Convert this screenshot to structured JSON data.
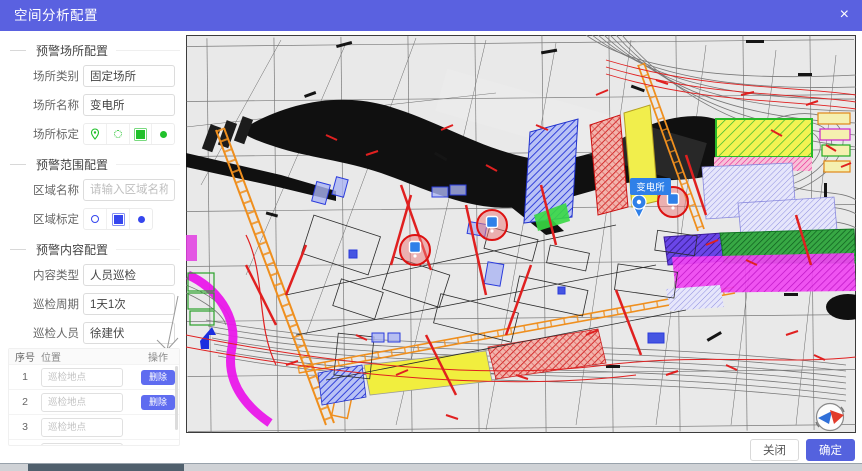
{
  "dialog": {
    "title": "空间分析配置",
    "close_glyph": "×"
  },
  "colors": {
    "titlebar": "#5a61e0",
    "primary_button": "#5462de",
    "delete_button": "#5f6cf0",
    "place_tools_green": "#21c12b",
    "range_tools_blue": "#3546ee",
    "inspect_tools_red": "#ee2f2f",
    "map_marker_blue": "#2f80e8",
    "inspection_circle_red": "#dd1111"
  },
  "sections": {
    "place": {
      "title": "预警场所配置",
      "category_label": "场所类别",
      "category_value": "固定场所",
      "name_label": "场所名称",
      "name_value": "变电所",
      "calibrate_label": "场所标定",
      "tool_icons": [
        "map-pin",
        "circle",
        "square",
        "dot"
      ]
    },
    "range": {
      "title": "预警范围配置",
      "area_label": "区域名称",
      "area_placeholder": "请输入区域名称",
      "calibrate_label": "区域标定",
      "tool_icons": [
        "circle",
        "square",
        "dot"
      ]
    },
    "content": {
      "title": "预警内容配置",
      "type_label": "内容类型",
      "type_value": "人员巡检",
      "cycle_label": "巡检周期",
      "cycle_value": "1天1次",
      "person_label": "巡检人员",
      "person_value": "徐建伏",
      "location_label": "巡检地点",
      "tool_icons": [
        "circle",
        "square",
        "dot"
      ]
    }
  },
  "table": {
    "headers": {
      "index": "序号",
      "location": "位置",
      "action": "操作"
    },
    "location_placeholder": "巡检地点",
    "delete_label": "删除",
    "rows": [
      {
        "index": "1"
      },
      {
        "index": "2"
      },
      {
        "index": "3"
      }
    ]
  },
  "map": {
    "marker_label": "变电所",
    "inspection_point_count": 3
  },
  "footer": {
    "close_label": "关闭",
    "confirm_label": "确定"
  }
}
